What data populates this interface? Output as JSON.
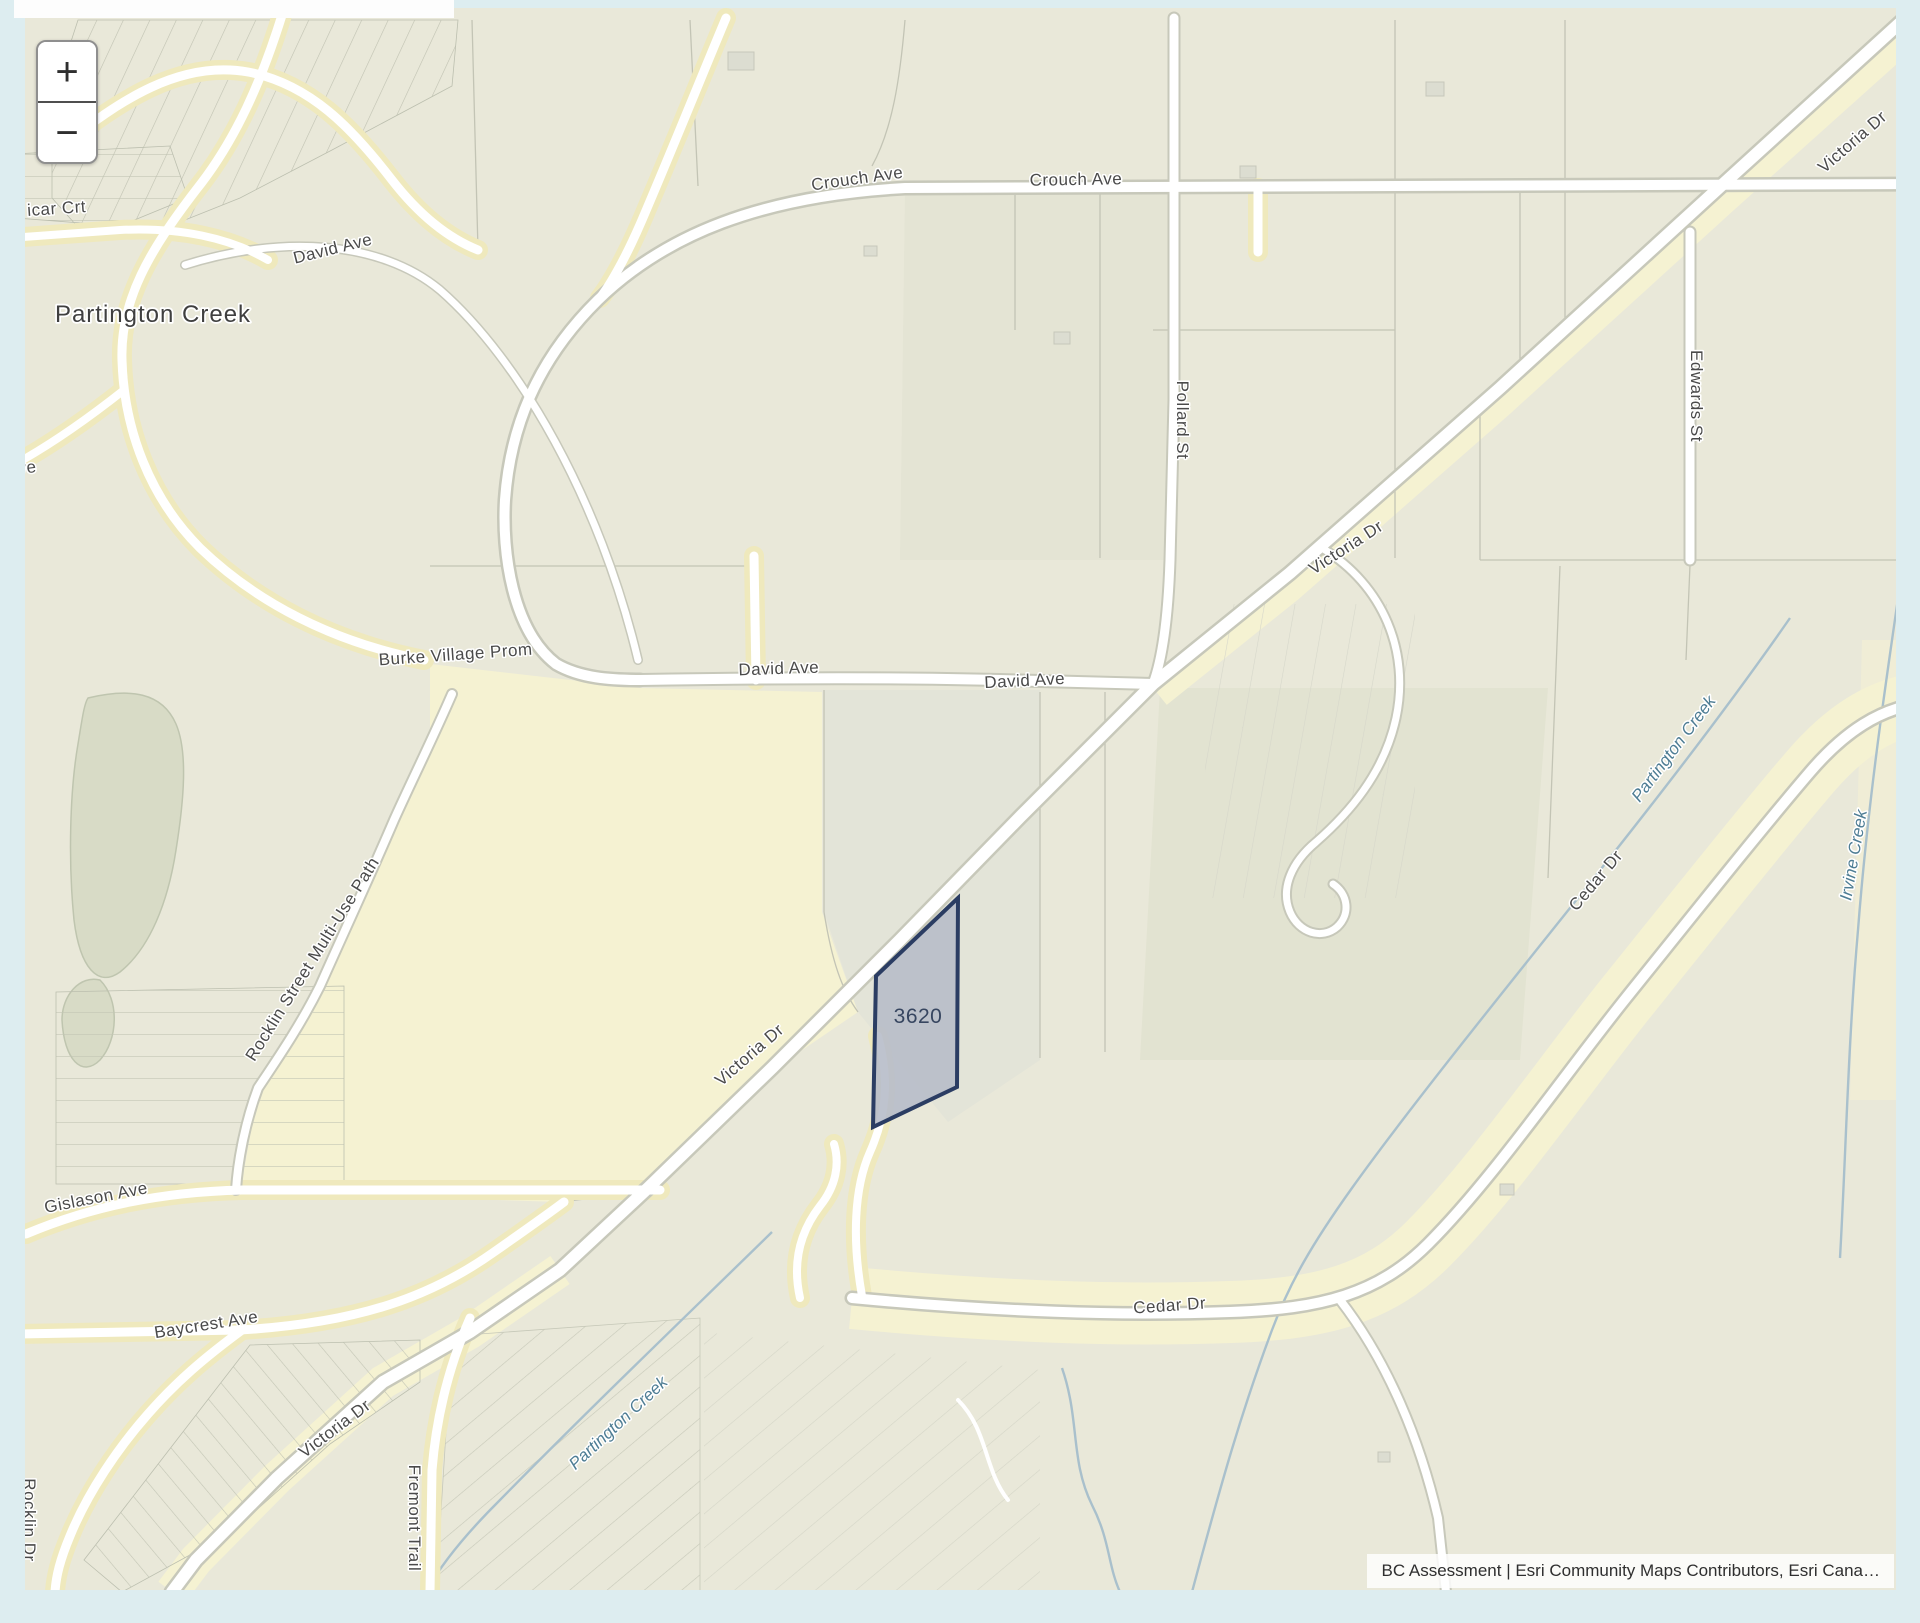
{
  "page": {
    "background": "#ddedf0"
  },
  "map": {
    "controls": {
      "zoom_in": "+",
      "zoom_out": "−"
    },
    "attribution": "BC Assessment | Esri Community Maps Contributors, Esri Cana…",
    "selected_parcel": {
      "label": "3620",
      "fill": "#b7bdc9",
      "outline": "#2b3d63"
    },
    "colors": {
      "page_background": "#ddedf0",
      "parcel_base": "#e9e8d9",
      "road_corridor_yellow": "#f5f2d2",
      "road_fill": "#ffffff",
      "road_casing": "#c7c8ba",
      "creek_blue": "#a9c0cc",
      "street_label": "#4a4a4a",
      "creek_label": "#4e7d94"
    },
    "labels": [
      {
        "slug": "icar-crt",
        "text": "icar Crt",
        "x": 57,
        "y": 214,
        "rot": -4,
        "kind": "street"
      },
      {
        "slug": "partington-creek-place",
        "text": "Partington Creek",
        "x": 153,
        "y": 322,
        "rot": 0,
        "kind": "place"
      },
      {
        "slug": "david-ave-northwest",
        "text": "David Ave",
        "x": 334,
        "y": 254,
        "rot": -14,
        "kind": "street"
      },
      {
        "slug": "crouch-ave-west",
        "text": "Crouch Ave",
        "x": 858,
        "y": 184,
        "rot": -8,
        "kind": "street"
      },
      {
        "slug": "crouch-ave-east",
        "text": "Crouch Ave",
        "x": 1076,
        "y": 185,
        "rot": -1,
        "kind": "street"
      },
      {
        "slug": "ave-partial",
        "text": "Ave",
        "x": 22,
        "y": 474,
        "rot": -8,
        "kind": "street"
      },
      {
        "slug": "burke-village-prom",
        "text": "Burke Village Prom",
        "x": 456,
        "y": 660,
        "rot": -4,
        "kind": "street"
      },
      {
        "slug": "david-ave-center-west",
        "text": "David Ave",
        "x": 779,
        "y": 674,
        "rot": -2,
        "kind": "street"
      },
      {
        "slug": "david-ave-center-east",
        "text": "David Ave",
        "x": 1025,
        "y": 686,
        "rot": -3,
        "kind": "street"
      },
      {
        "slug": "victoria-dr-top-right",
        "text": "Victoria Dr",
        "x": 1856,
        "y": 146,
        "rot": -41,
        "kind": "street"
      },
      {
        "slug": "victoria-dr-upper",
        "text": "Victoria Dr",
        "x": 1349,
        "y": 552,
        "rot": -33,
        "kind": "street"
      },
      {
        "slug": "victoria-dr-center",
        "text": "Victoria Dr",
        "x": 753,
        "y": 1059,
        "rot": -41,
        "kind": "street"
      },
      {
        "slug": "victoria-dr-bottom",
        "text": "Victoria Dr",
        "x": 338,
        "y": 1433,
        "rot": -37,
        "kind": "street"
      },
      {
        "slug": "pollard-st",
        "text": "Pollard St",
        "x": 1177,
        "y": 420,
        "rot": 90,
        "kind": "street"
      },
      {
        "slug": "edwards-st",
        "text": "Edwards St",
        "x": 1691,
        "y": 396,
        "rot": 90,
        "kind": "street"
      },
      {
        "slug": "rocklin-street-multi-use-path",
        "text": "Rocklin Street Multi-Use Path",
        "x": 317,
        "y": 962,
        "rot": -58,
        "kind": "street"
      },
      {
        "slug": "gislason-ave",
        "text": "Gislason Ave",
        "x": 97,
        "y": 1203,
        "rot": -11,
        "kind": "street"
      },
      {
        "slug": "baycrest-ave",
        "text": "Baycrest Ave",
        "x": 207,
        "y": 1330,
        "rot": -9,
        "kind": "street"
      },
      {
        "slug": "fremont-trail",
        "text": "Fremont Trail",
        "x": 409,
        "y": 1518,
        "rot": 90,
        "kind": "street"
      },
      {
        "slug": "rocklin-dr",
        "text": "Rocklin Dr",
        "x": 24,
        "y": 1520,
        "rot": 90,
        "kind": "street"
      },
      {
        "slug": "cedar-dr-south",
        "text": "Cedar Dr",
        "x": 1170,
        "y": 1311,
        "rot": -4,
        "kind": "street"
      },
      {
        "slug": "cedar-dr-east",
        "text": "Cedar Dr",
        "x": 1600,
        "y": 884,
        "rot": -50,
        "kind": "street"
      },
      {
        "slug": "partington-creek-southwest",
        "text": "Partington Creek",
        "x": 622,
        "y": 1427,
        "rot": -43,
        "kind": "creek"
      },
      {
        "slug": "partington-creek-east",
        "text": "Partington Creek",
        "x": 1678,
        "y": 752,
        "rot": -53,
        "kind": "creek"
      },
      {
        "slug": "irvine-creek",
        "text": "Irvine Creek",
        "x": 1859,
        "y": 856,
        "rot": -80,
        "kind": "creek"
      },
      {
        "slug": "parcel-3620",
        "text": "3620",
        "x": 918,
        "y": 1023,
        "rot": 0,
        "kind": "parcel"
      }
    ]
  }
}
